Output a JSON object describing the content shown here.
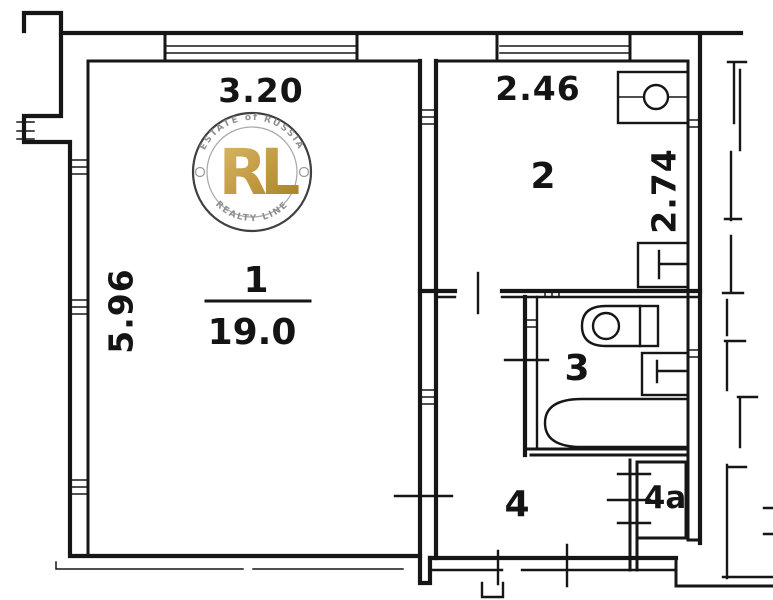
{
  "plan": {
    "dimensions": {
      "room1_width_m": "3.20",
      "room1_depth_m": "5.96",
      "room2_width_m": "2.46",
      "room2_depth_m": "2.74"
    },
    "rooms": [
      {
        "number": "1",
        "area_m2": "19.0"
      },
      {
        "number": "2"
      },
      {
        "number": "3"
      },
      {
        "number": "4"
      },
      {
        "number": "4a"
      }
    ],
    "fixtures": [
      "kitchen-sink",
      "stove",
      "toilet",
      "washbasin",
      "bathtub"
    ],
    "watermark": {
      "arc_top": "ESTATE of RUSSIA",
      "monogram": "RL",
      "arc_bottom": "REALTY LINE"
    },
    "colors": {
      "ink": "#161616",
      "gold": "#c29b43",
      "watermark_ring": "#3f3f3f",
      "watermark_text": "#8f8f8f"
    }
  }
}
